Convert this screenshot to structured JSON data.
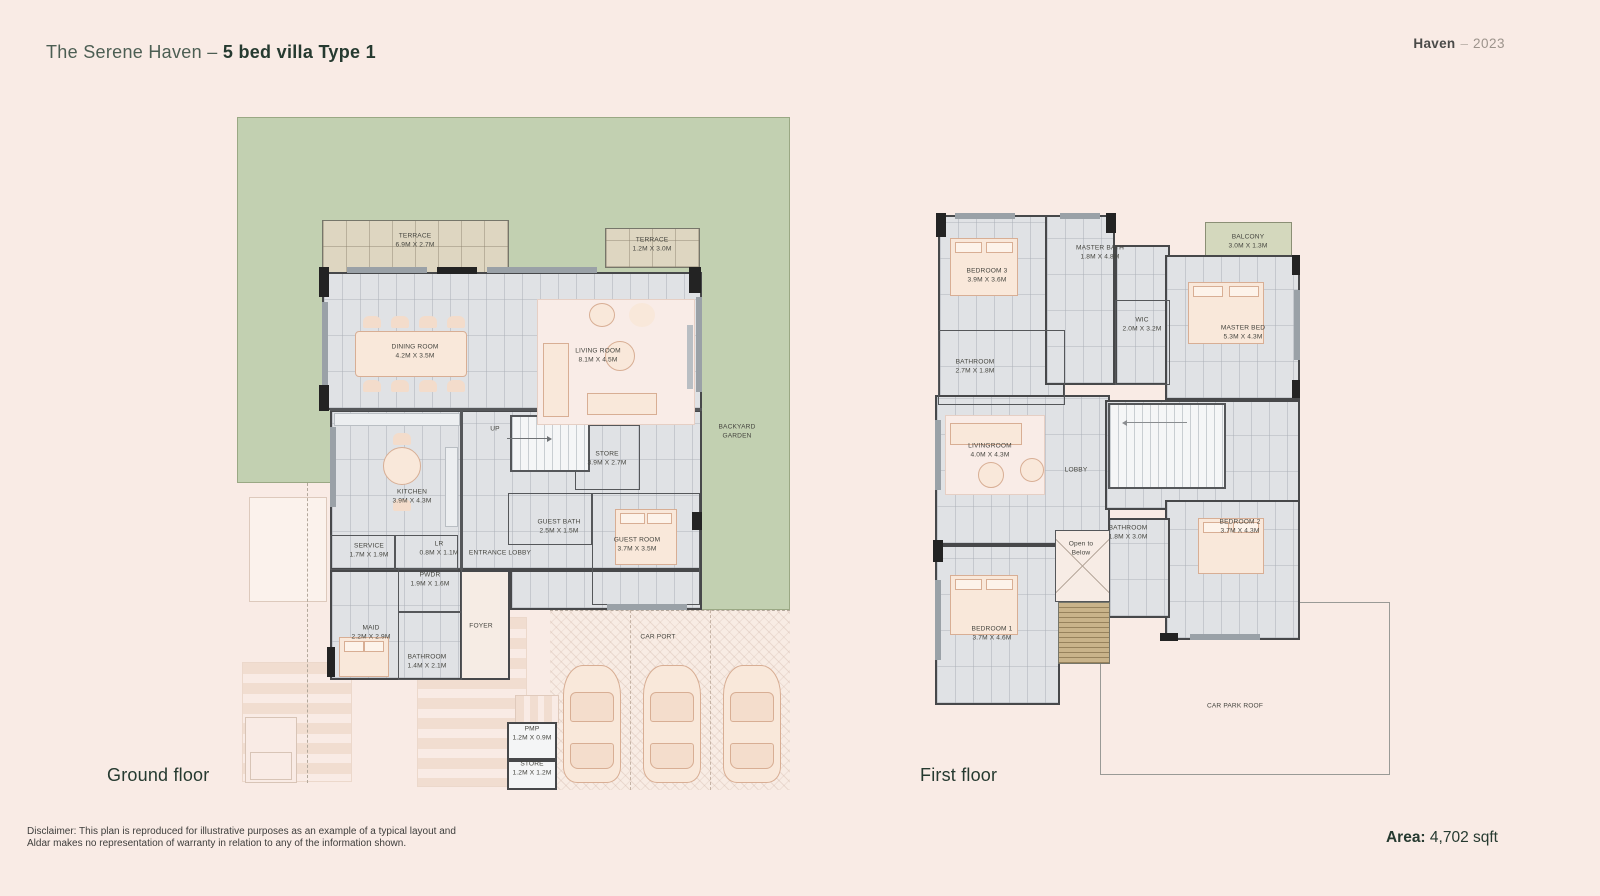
{
  "header": {
    "title_regular": "The Serene Haven",
    "title_sep": " – ",
    "title_bold": "5 bed villa Type 1",
    "brand_name": "Haven",
    "brand_sep": "–",
    "brand_year": "2023"
  },
  "ground_floor": {
    "label": "Ground floor",
    "annotations": [
      {
        "lines": [
          "TERRACE",
          "6.9M X 2.7M"
        ],
        "x": 178,
        "y": 124
      },
      {
        "lines": [
          "TERRACE",
          "1.2M X 3.0M"
        ],
        "x": 415,
        "y": 128
      },
      {
        "lines": [
          "DINING ROOM",
          "4.2M X 3.5M"
        ],
        "x": 178,
        "y": 235
      },
      {
        "lines": [
          "LIVING ROOM",
          "8.1M X 4.5M"
        ],
        "x": 361,
        "y": 239
      },
      {
        "lines": [
          "KITCHEN",
          "3.9M X 4.3M"
        ],
        "x": 175,
        "y": 380
      },
      {
        "lines": [
          "UP"
        ],
        "x": 258,
        "y": 313
      },
      {
        "lines": [
          "STORE",
          "3.9M X 2.7M"
        ],
        "x": 370,
        "y": 342
      },
      {
        "lines": [
          "SERVICE",
          "1.7M X 1.9M"
        ],
        "x": 132,
        "y": 434
      },
      {
        "lines": [
          "LR",
          "0.8M X 1.1M"
        ],
        "x": 202,
        "y": 432
      },
      {
        "lines": [
          "ENTRANCE LOBBY"
        ],
        "x": 263,
        "y": 437
      },
      {
        "lines": [
          "GUEST BATH",
          "2.5M X 1.5M"
        ],
        "x": 322,
        "y": 410
      },
      {
        "lines": [
          "GUEST ROOM",
          "3.7M X 3.5M"
        ],
        "x": 400,
        "y": 428
      },
      {
        "lines": [
          "PWDR",
          "1.9M X 1.6M"
        ],
        "x": 193,
        "y": 463
      },
      {
        "lines": [
          "MAID",
          "2.2M X 2.9M"
        ],
        "x": 134,
        "y": 516
      },
      {
        "lines": [
          "BATHROOM",
          "1.4M X 2.1M"
        ],
        "x": 190,
        "y": 545
      },
      {
        "lines": [
          "FOYER"
        ],
        "x": 244,
        "y": 510
      },
      {
        "lines": [
          "PMP",
          "1.2M X 0.9M"
        ],
        "x": 295,
        "y": 617
      },
      {
        "lines": [
          "STORE",
          "1.2M X 1.2M"
        ],
        "x": 295,
        "y": 652
      },
      {
        "lines": [
          "CAR PORT"
        ],
        "x": 421,
        "y": 521
      },
      {
        "lines": [
          "BACKYARD",
          "GARDEN"
        ],
        "x": 500,
        "y": 315
      }
    ]
  },
  "first_floor": {
    "label": "First floor",
    "annotations": [
      {
        "lines": [
          "BEDROOM 3",
          "3.9M X 3.6M"
        ],
        "x": 67,
        "y": 66
      },
      {
        "lines": [
          "MASTER BATH",
          "1.8M X 4.8M"
        ],
        "x": 180,
        "y": 43
      },
      {
        "lines": [
          "BALCONY",
          "3.0M X 1.3M"
        ],
        "x": 328,
        "y": 32
      },
      {
        "lines": [
          "WIC",
          "2.0M X 3.2M"
        ],
        "x": 222,
        "y": 115
      },
      {
        "lines": [
          "MASTER BED",
          "5.3M X 4.3M"
        ],
        "x": 323,
        "y": 123
      },
      {
        "lines": [
          "BATHROOM",
          "2.7M X 1.8M"
        ],
        "x": 55,
        "y": 157
      },
      {
        "lines": [
          "LIVINGROOM",
          "4.0M X 4.3M"
        ],
        "x": 70,
        "y": 241
      },
      {
        "lines": [
          "LOBBY"
        ],
        "x": 156,
        "y": 261
      },
      {
        "lines": [
          "Open to",
          "Below"
        ],
        "x": 161,
        "y": 339
      },
      {
        "lines": [
          "BATHROOM",
          "1.8M X 3.0M"
        ],
        "x": 208,
        "y": 323
      },
      {
        "lines": [
          "BEDROOM 2",
          "3.7M X 4.3M"
        ],
        "x": 320,
        "y": 317
      },
      {
        "lines": [
          "BEDROOM 1",
          "3.7M X 4.6M"
        ],
        "x": 72,
        "y": 424
      },
      {
        "lines": [
          "CAR PARK ROOF"
        ],
        "x": 315,
        "y": 497
      }
    ]
  },
  "footer": {
    "disclaimer_line1": "Disclaimer: This plan is reproduced for illustrative purposes as an example of a typical layout and",
    "disclaimer_line2": "Aldar makes no representation of warranty in relation to any of the information shown.",
    "area_label": "Area:",
    "area_value": " 4,702 sqft"
  },
  "colors": {
    "background": "#f9ebe5",
    "garden_green": "#c2d0b1",
    "terrace_tan": "#ded6c1",
    "balcony_olive": "#d4d8bd",
    "floor_gray": "#e0e2e5",
    "wall_dark": "#47484a",
    "accent_green": "#263a30",
    "furniture_peach": "#f9e8da"
  }
}
